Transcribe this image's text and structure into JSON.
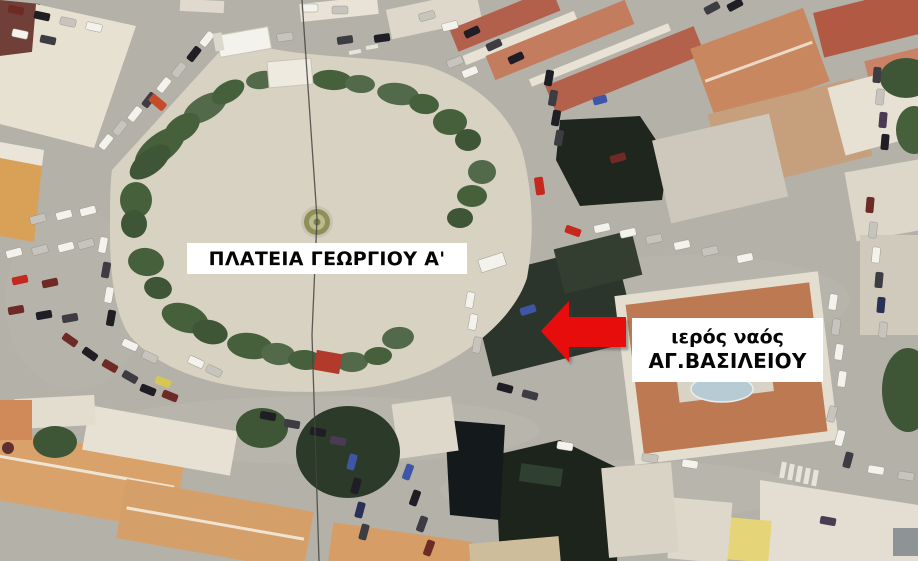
{
  "map": {
    "kind": "aerial-photograph",
    "annotations": {
      "plaza_label": "ΠΛΑΤΕΙΑ ΓΕΩΡΓΙΟΥ Α'",
      "church_label_line1": "ιερός ναός",
      "church_label_line2": "ΑΓ.ΒΑΣΙΛΕΙΟΥ"
    },
    "colors": {
      "arrow": "#e80a0a",
      "label_background": "#ffffff",
      "label_text": "#050505",
      "road": "#b4b1a9",
      "plaza": "#d7d2c2",
      "tree": "#47603c",
      "terracotta_roof": "#c07a58",
      "white_roof": "#e7e1d2",
      "church_roof": "#2b352c",
      "dome": "#b7cbd4"
    }
  }
}
